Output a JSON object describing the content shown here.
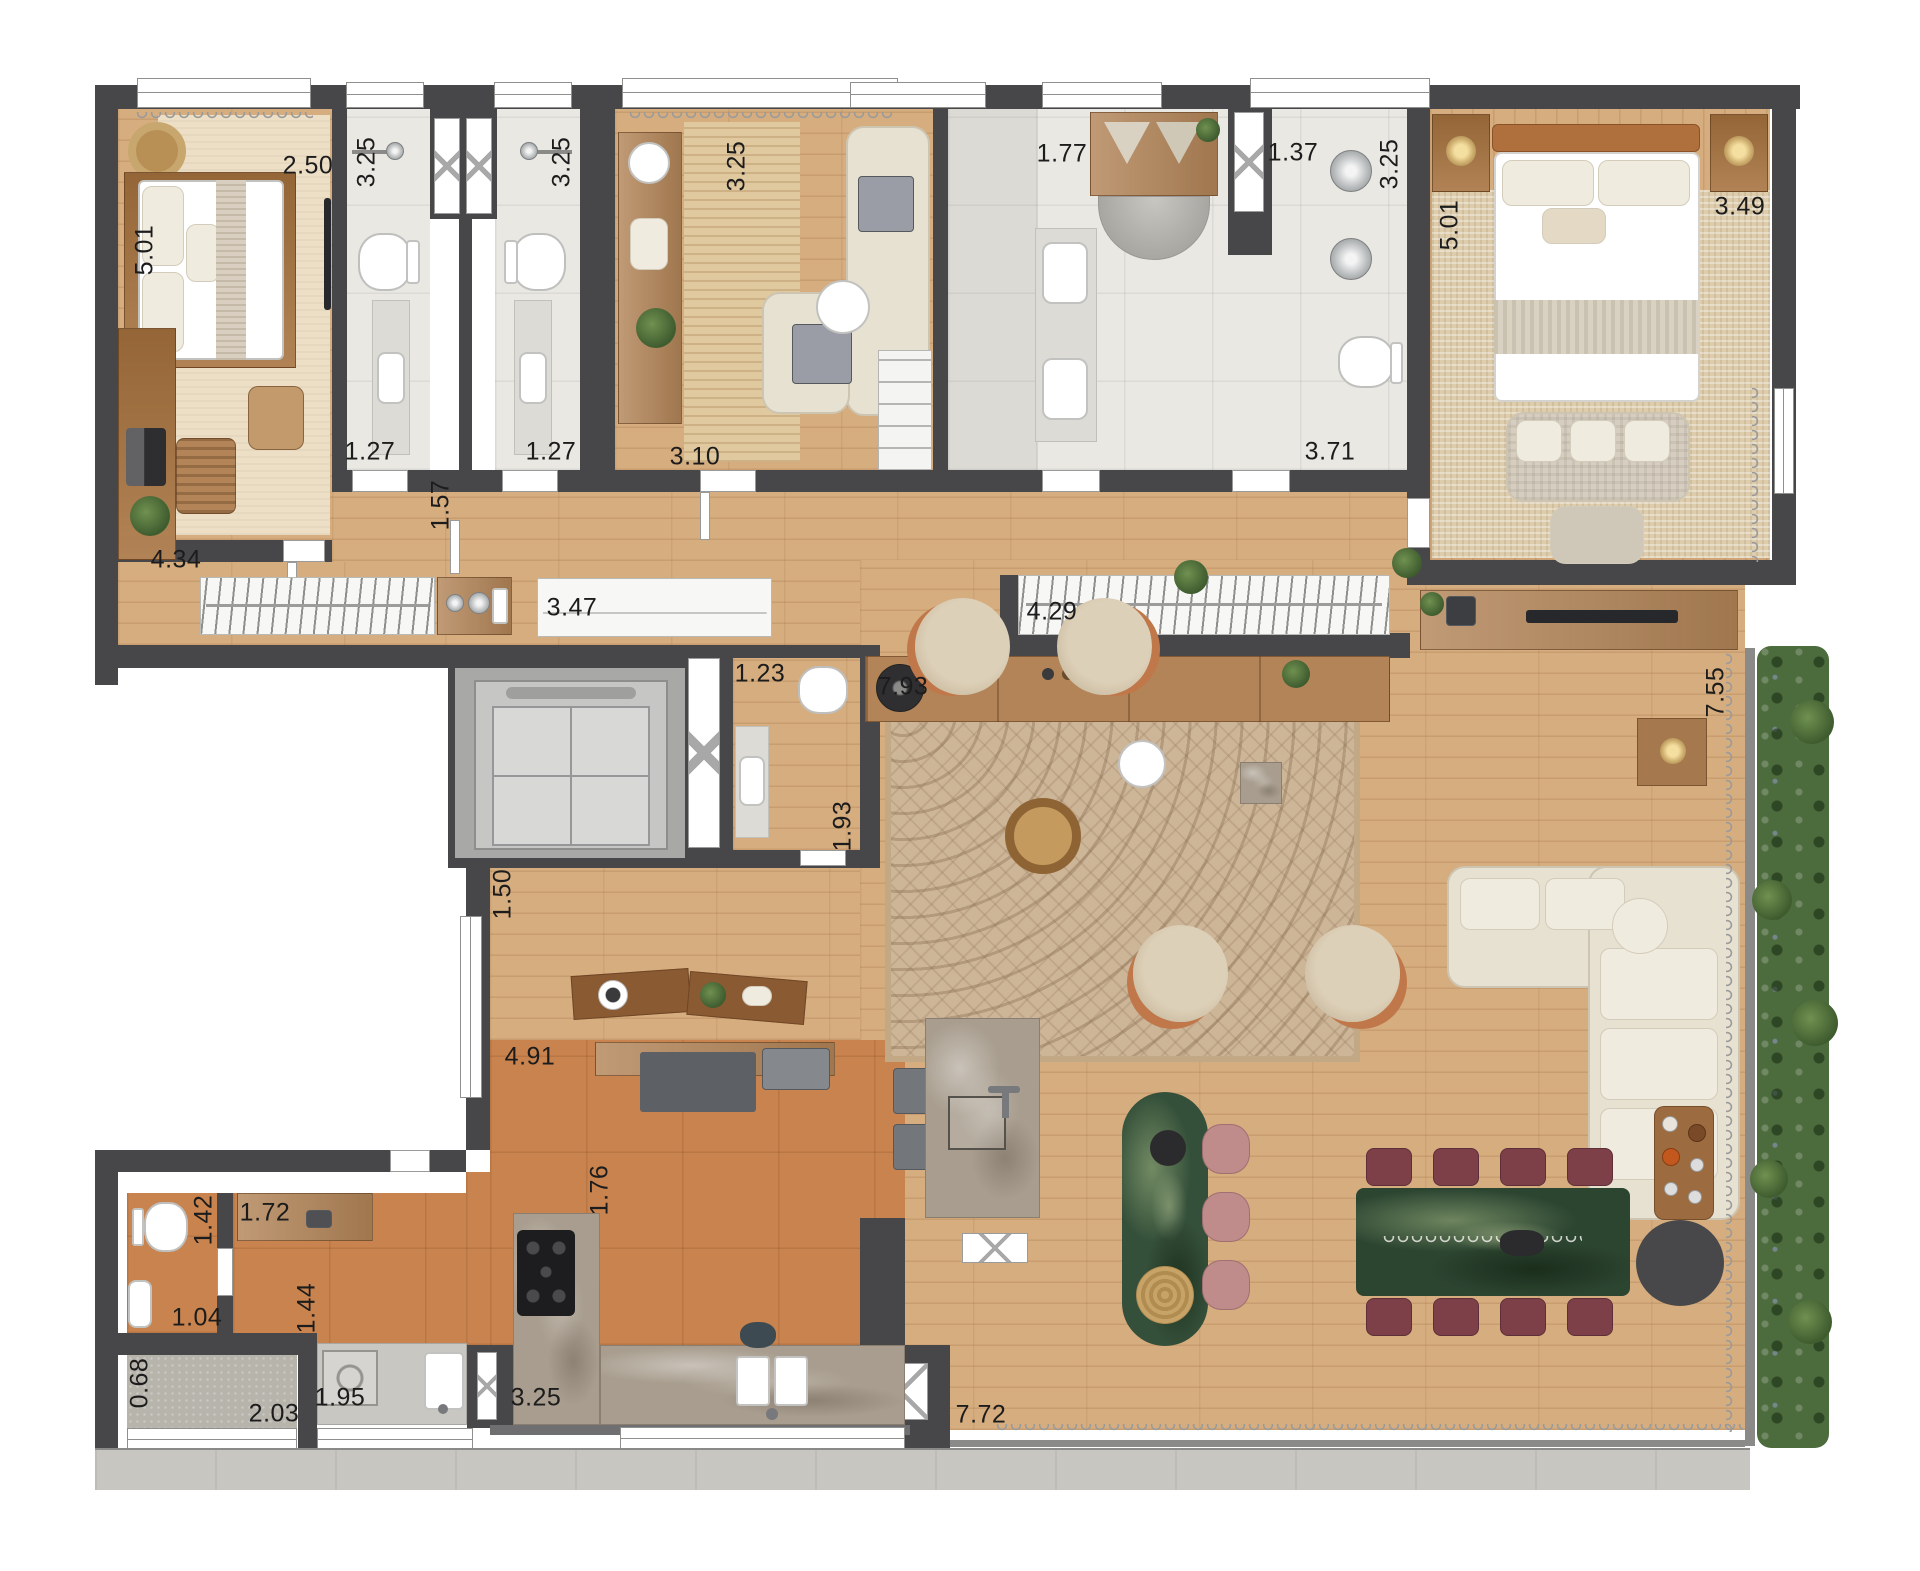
{
  "title": "apartment-floor-plan",
  "labels": [
    {
      "t": "2.50",
      "room": "bedroom-1",
      "axis": "h"
    },
    {
      "t": "5.01",
      "room": "bedroom-1",
      "axis": "v"
    },
    {
      "t": "4.34",
      "room": "bedroom-1",
      "axis": "h"
    },
    {
      "t": "3.25",
      "room": "bathroom-1",
      "axis": "v"
    },
    {
      "t": "1.27",
      "room": "bathroom-1",
      "axis": "h"
    },
    {
      "t": "3.25",
      "room": "bathroom-2",
      "axis": "v"
    },
    {
      "t": "1.27",
      "room": "bathroom-2",
      "axis": "h"
    },
    {
      "t": "3.25",
      "room": "study",
      "axis": "v"
    },
    {
      "t": "3.10",
      "room": "study",
      "axis": "h"
    },
    {
      "t": "1.77",
      "room": "master-bathroom",
      "axis": "h"
    },
    {
      "t": "1.37",
      "room": "master-bathroom",
      "axis": "h"
    },
    {
      "t": "3.25",
      "room": "master-bathroom",
      "axis": "v"
    },
    {
      "t": "3.71",
      "room": "master-bathroom",
      "axis": "h"
    },
    {
      "t": "5.01",
      "room": "master-bedroom",
      "axis": "v"
    },
    {
      "t": "3.49",
      "room": "master-bedroom",
      "axis": "h"
    },
    {
      "t": "1.57",
      "room": "corridor",
      "axis": "v"
    },
    {
      "t": "3.47",
      "room": "corridor-wardrobe",
      "axis": "h"
    },
    {
      "t": "4.29",
      "room": "hall-closet",
      "axis": "h"
    },
    {
      "t": "7.93",
      "room": "hall",
      "axis": "h"
    },
    {
      "t": "1.23",
      "room": "lavabo",
      "axis": "h"
    },
    {
      "t": "1.93",
      "room": "lavabo",
      "axis": "v"
    },
    {
      "t": "1.50",
      "room": "kitchen-corridor",
      "axis": "v"
    },
    {
      "t": "4.91",
      "room": "kitchen",
      "axis": "h"
    },
    {
      "t": "1.76",
      "room": "kitchen",
      "axis": "v"
    },
    {
      "t": "7.55",
      "room": "living-room",
      "axis": "v"
    },
    {
      "t": "7.72",
      "room": "living-room",
      "axis": "h"
    },
    {
      "t": "1.42",
      "room": "service-wc",
      "axis": "v"
    },
    {
      "t": "1.04",
      "room": "service-wc",
      "axis": "h"
    },
    {
      "t": "1.72",
      "room": "service-corridor",
      "axis": "h"
    },
    {
      "t": "1.44",
      "room": "service-corridor",
      "axis": "v"
    },
    {
      "t": "0.68",
      "room": "service-balcony",
      "axis": "v"
    },
    {
      "t": "2.03",
      "room": "service-balcony",
      "axis": "h"
    },
    {
      "t": "1.95",
      "room": "laundry",
      "axis": "h"
    },
    {
      "t": "3.25",
      "room": "kitchen-counter",
      "axis": "h"
    }
  ],
  "colors": {
    "wall": "#47474a",
    "wood": "#d6ad7f",
    "tile": "#e9e8e3",
    "terracotta": "#c8834e",
    "rug_cream": "#ecdfc6",
    "marble": "#a89d8e",
    "green_marble": "#35503a",
    "chair_terracotta": "#c0784a",
    "dining_chair": "#7d4049",
    "plants": "#4c6c3d",
    "concrete": "#b7b4ac"
  }
}
